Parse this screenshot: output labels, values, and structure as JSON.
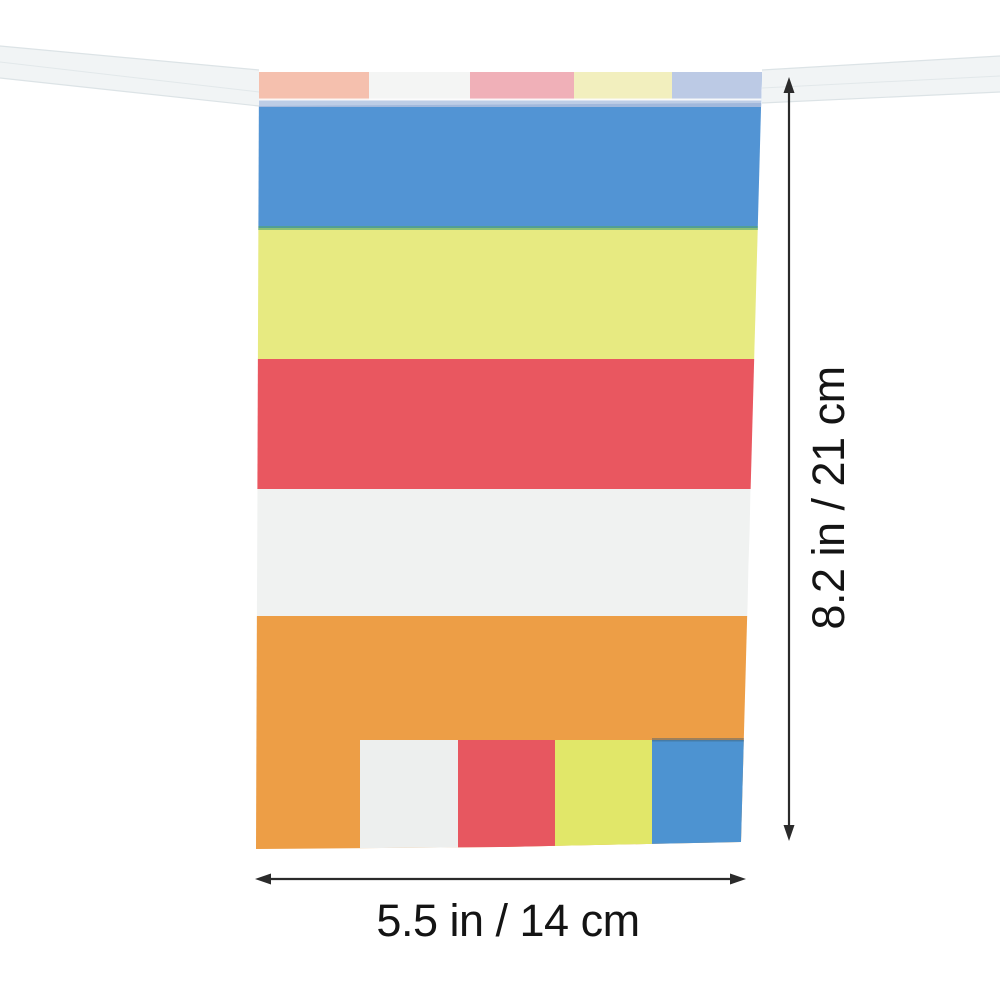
{
  "image": {
    "background": "#ffffff"
  },
  "ribbon": {
    "color": "#f1f4f5",
    "edge_color": "#dce3e6",
    "stitch_color": "#ffffff"
  },
  "flag": {
    "stripes": [
      {
        "name": "blue",
        "color": "#4b91d5"
      },
      {
        "name": "yellow",
        "color": "#e9ec7d"
      },
      {
        "name": "red",
        "color": "#eb5059"
      },
      {
        "name": "white",
        "color": "#f3f5f4"
      },
      {
        "name": "orange",
        "color": "#f09b3e"
      }
    ],
    "top_fold_blocks": [
      {
        "name": "peach",
        "color": "#f4a488"
      },
      {
        "name": "white",
        "color": "#f2f4f3"
      },
      {
        "name": "pink",
        "color": "#ec8a97"
      },
      {
        "name": "pale-yellow",
        "color": "#f0eaa0"
      },
      {
        "name": "pale-blue",
        "color": "#9db3dc"
      }
    ],
    "bottom_blocks": [
      {
        "name": "white",
        "color": "#f0f2f1"
      },
      {
        "name": "red",
        "color": "#e9505a"
      },
      {
        "name": "yellow",
        "color": "#e3e963"
      },
      {
        "name": "blue",
        "color": "#4590d2"
      }
    ],
    "seam_green": "#4aa168",
    "seam_dark": "#33566e",
    "washed_blue_band": "#9fb7dd"
  },
  "annotations": {
    "height_label": "8.2 in / 21 cm",
    "width_label": "5.5 in / 14 cm",
    "line_color": "#2b2b2b",
    "text_color": "#141414"
  }
}
